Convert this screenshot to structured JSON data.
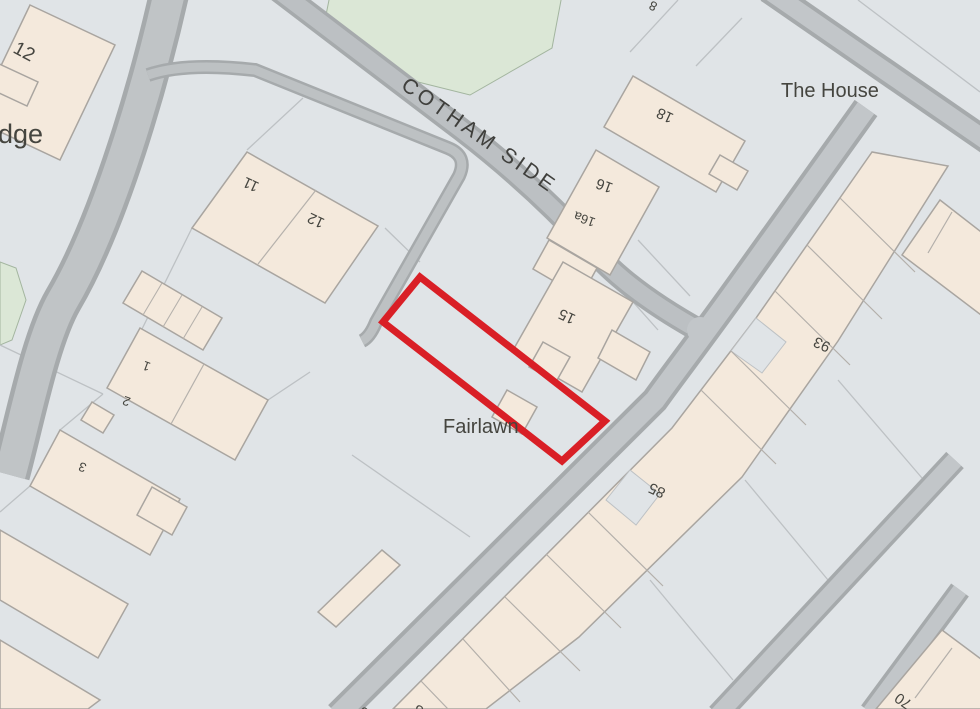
{
  "map": {
    "street": "COTHAM SIDE",
    "places": {
      "the_house": "The House",
      "fairlawn": "Fairlawn",
      "lodge_partial": "dge"
    },
    "numbers": {
      "topleft_12": "12",
      "n11": "11",
      "n12": "12",
      "n18": "18",
      "n16": "16",
      "n16a": "16a",
      "n15": "15",
      "n1": "1",
      "n2": "2",
      "n3": "3",
      "n93": "93",
      "n85": "85",
      "n70": "70",
      "partial_top": "8",
      "partial_bottom_a": "6",
      "partial_bottom_b": "8"
    }
  },
  "colors": {
    "background": "#e0e4e7",
    "road_fill": "#bcc0c3",
    "road_edge": "#a6aaac",
    "building_fill": "#f4e9dc",
    "building_edge": "#a9a5a0",
    "green_fill": "#dbe7d6",
    "plot_outline_red": "#d91f26",
    "label_text": "#45453f"
  }
}
